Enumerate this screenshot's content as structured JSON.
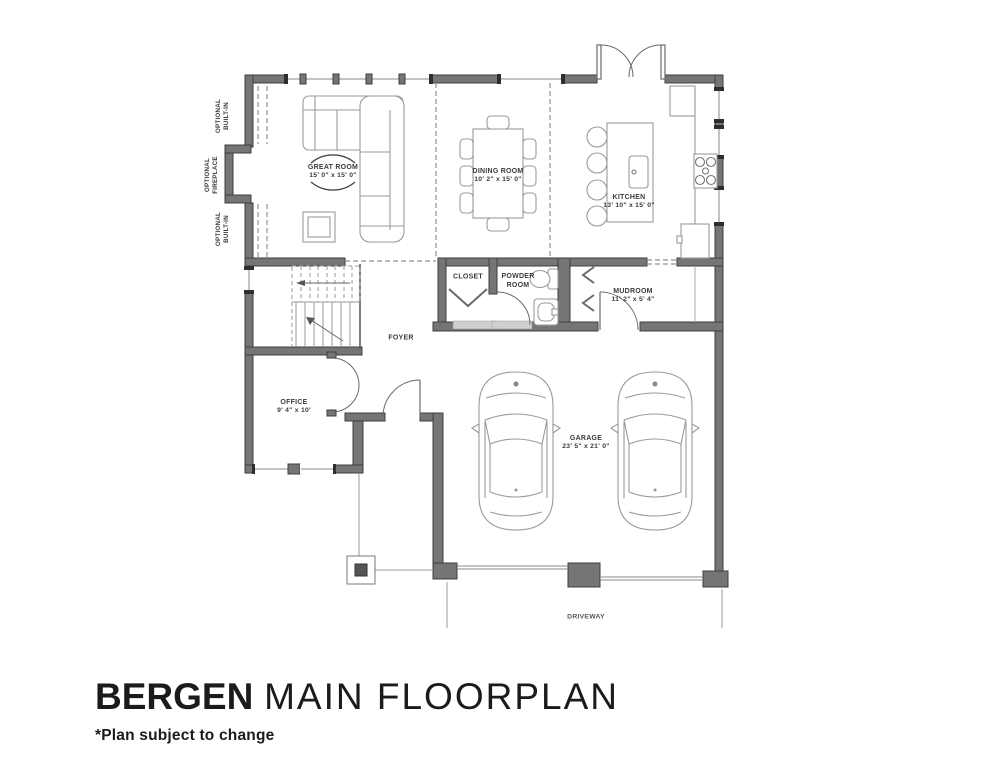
{
  "plan": {
    "rooms": {
      "great_room": {
        "name": "GREAT ROOM",
        "dims": "15' 0\" x 15' 0\""
      },
      "dining_room": {
        "name": "DINING ROOM",
        "dims": "10' 2\" x 15' 0\""
      },
      "kitchen": {
        "name": "KITCHEN",
        "dims": "13' 10\" x 15' 0\""
      },
      "mudroom": {
        "name": "MUDROOM",
        "dims": "11' 2\" x 5' 4\""
      },
      "office": {
        "name": "OFFICE",
        "dims": "9' 4\" x 10'"
      },
      "garage": {
        "name": "GARAGE",
        "dims": "23' 5\" x 21' 0\""
      },
      "closet": {
        "name": "CLOSET"
      },
      "powder_room": {
        "lines": [
          "POWDER",
          "ROOM"
        ]
      },
      "foyer": {
        "name": "FOYER"
      },
      "driveway": {
        "name": "DRIVEWAY"
      }
    },
    "annotations": {
      "optional_built_in_top": {
        "lines": [
          "OPTIONAL",
          "BUILT-IN"
        ]
      },
      "optional_fireplace": {
        "lines": [
          "OPTIONAL",
          "FIREPLACE"
        ]
      },
      "optional_built_in_bottom": {
        "lines": [
          "OPTIONAL",
          "BUILT-IN"
        ]
      }
    }
  },
  "footer": {
    "plan_name": "BERGEN",
    "plan_subtitle": "MAIN FLOORPLAN",
    "disclaimer": "*Plan subject to change"
  },
  "colors": {
    "wall_fill": "#757575",
    "wall_edge": "#3e3e3e",
    "furniture_line": "#9a9a9a",
    "dashed_line": "#8f8f8f",
    "label_text": "#3b3b3b",
    "title_text": "#1b1b1b"
  }
}
